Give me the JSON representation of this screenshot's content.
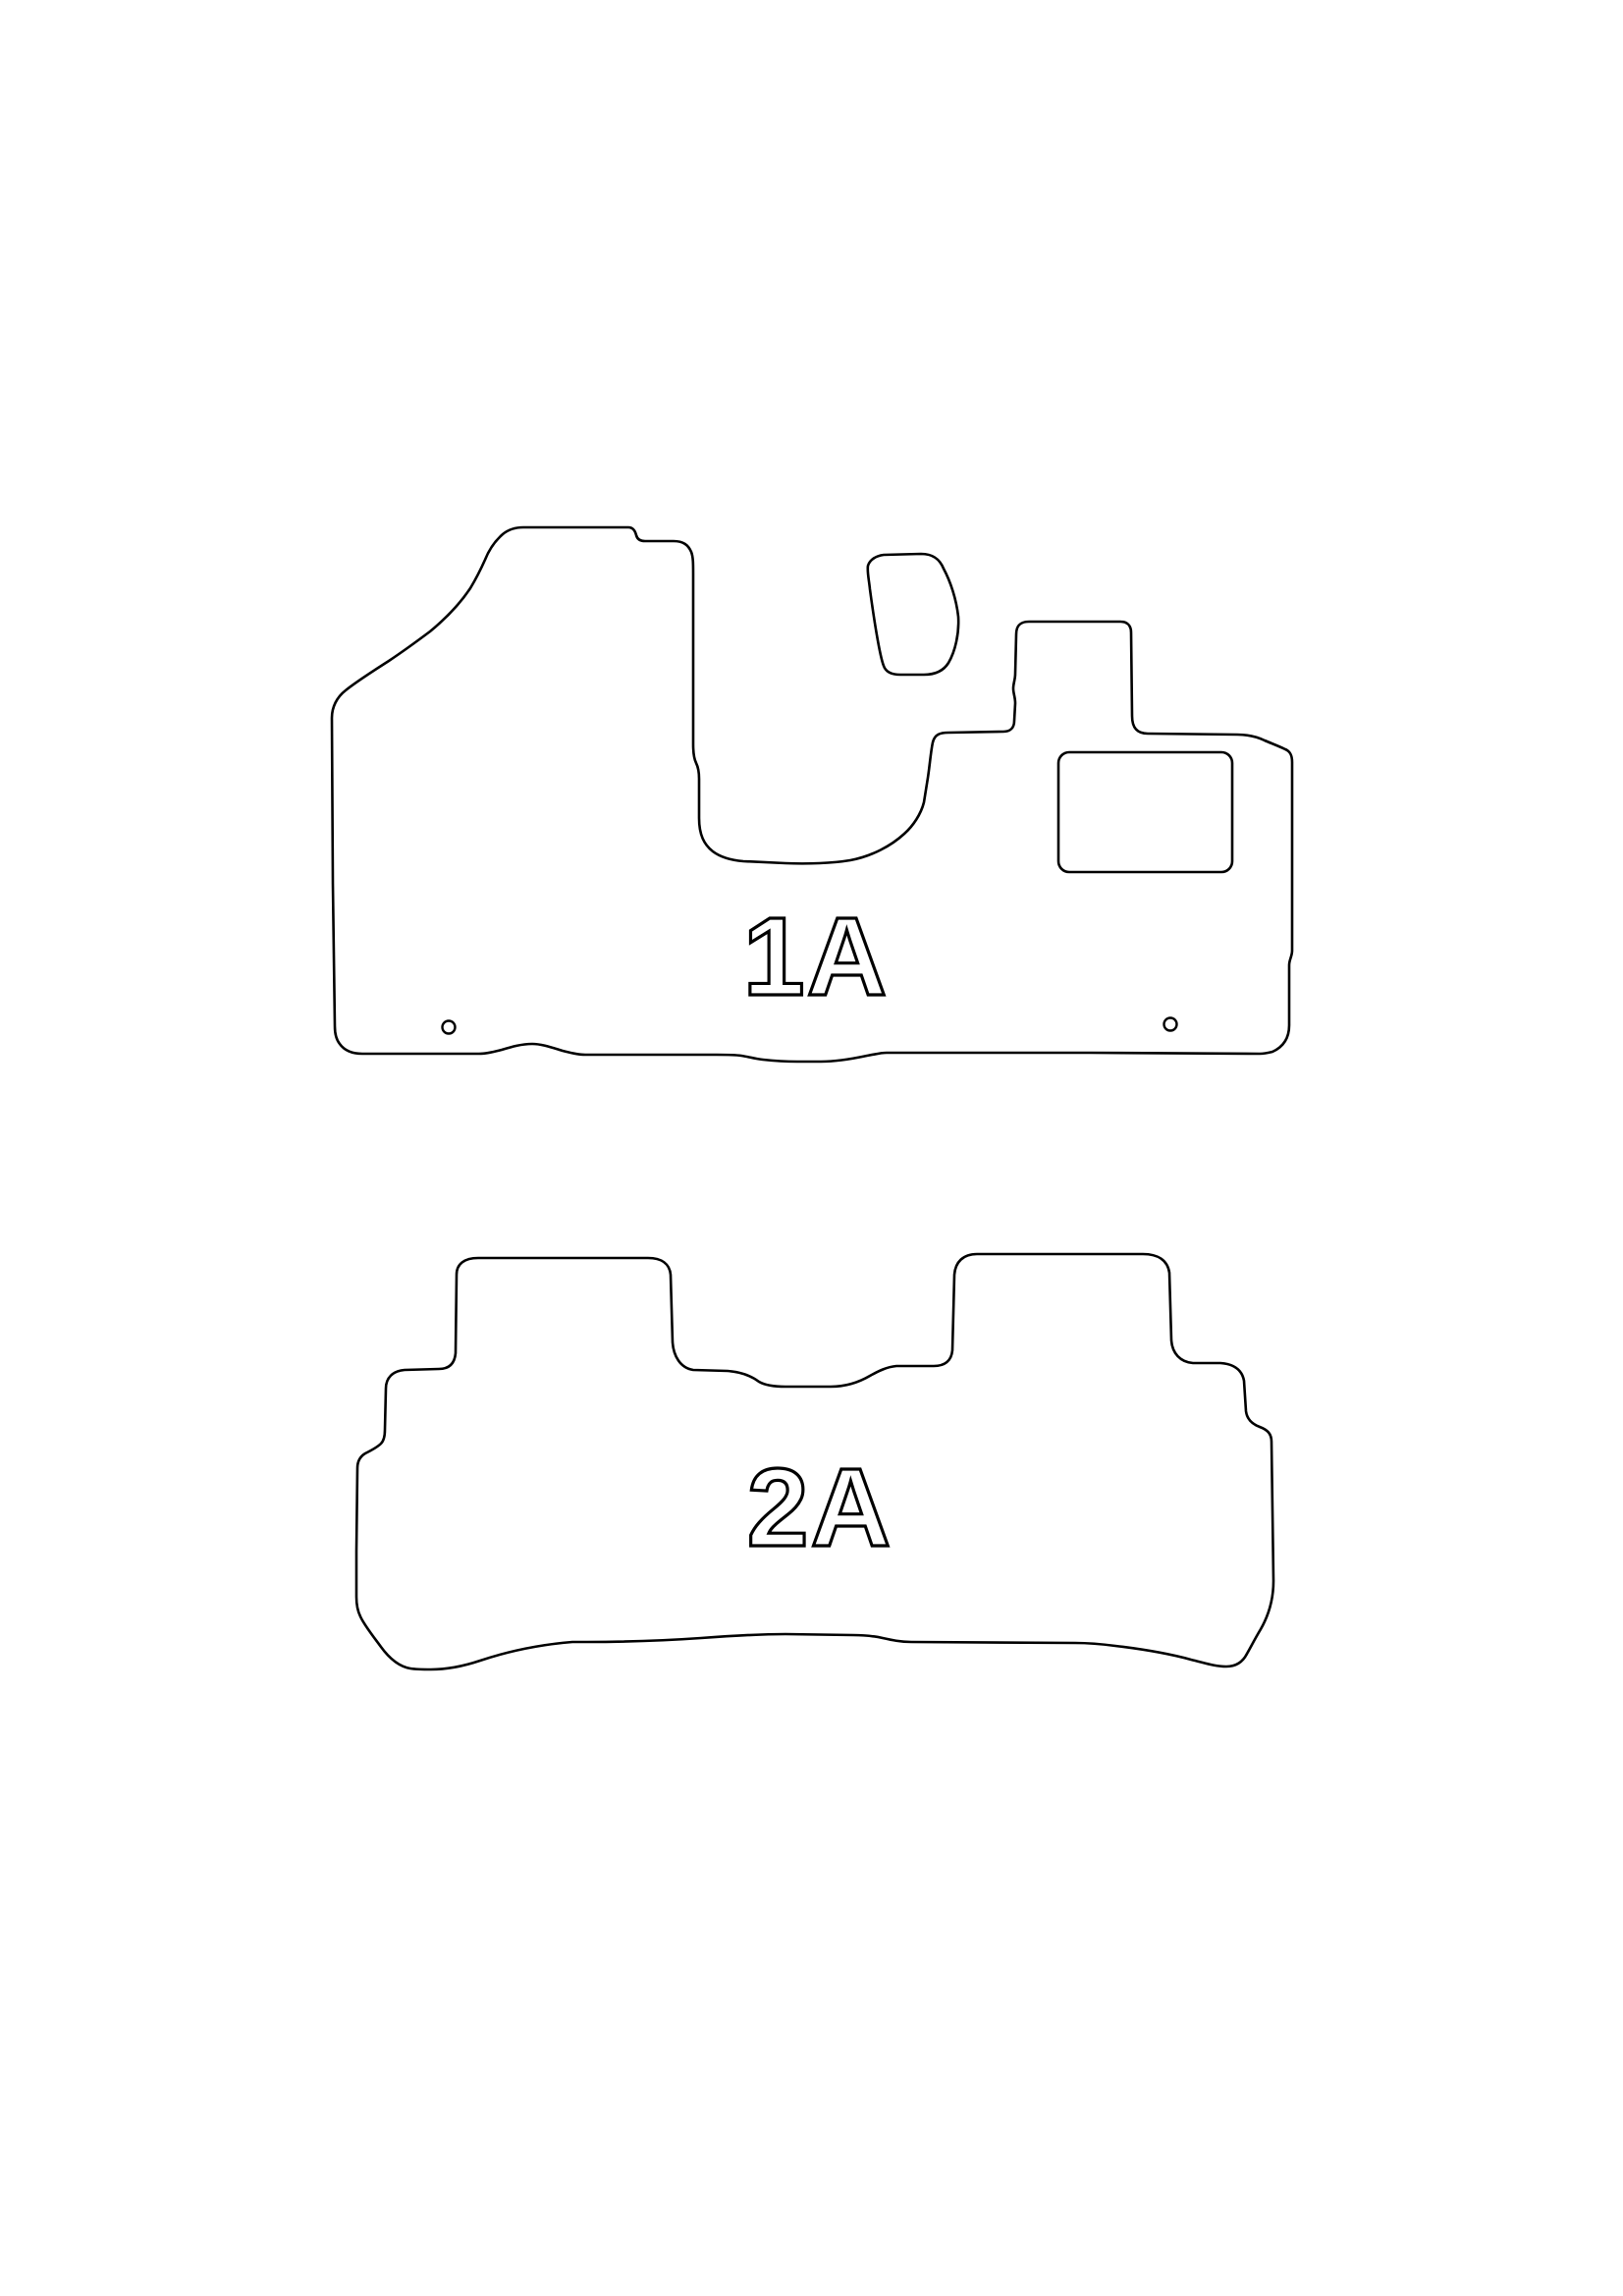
{
  "colors": {
    "background": "#ffffff",
    "ink": "#000000"
  },
  "mats": [
    {
      "label": "1A"
    },
    {
      "label": "2A"
    }
  ]
}
